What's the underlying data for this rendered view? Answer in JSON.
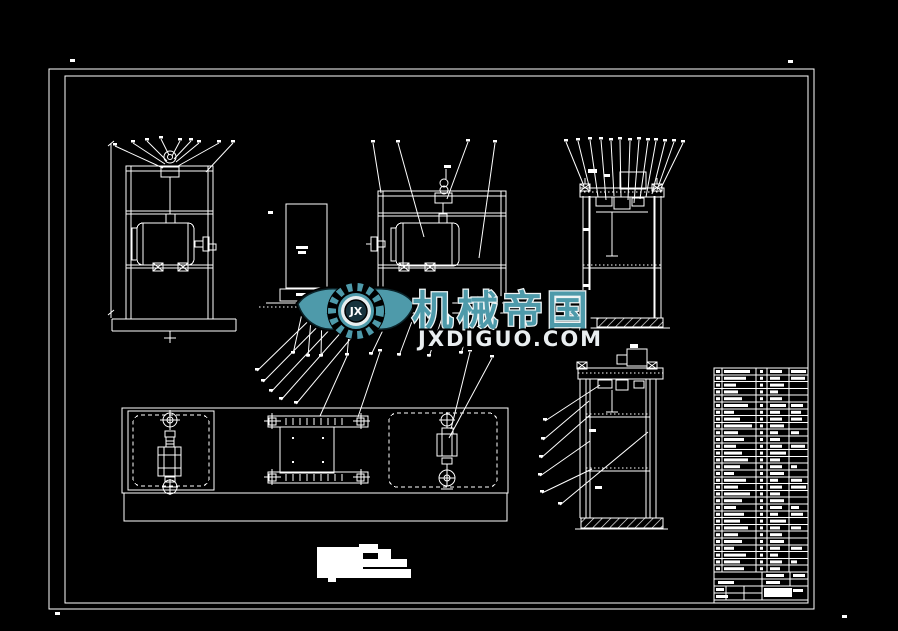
{
  "canvas": {
    "background": "#000000",
    "line_color": "#ffffff"
  },
  "watermark": {
    "brand": "机械帝国",
    "site": "JXDIGUO.COM",
    "monogram": "JX",
    "teal": "#4e9aaa",
    "light": "#e9eef0",
    "outline": "#000000"
  }
}
